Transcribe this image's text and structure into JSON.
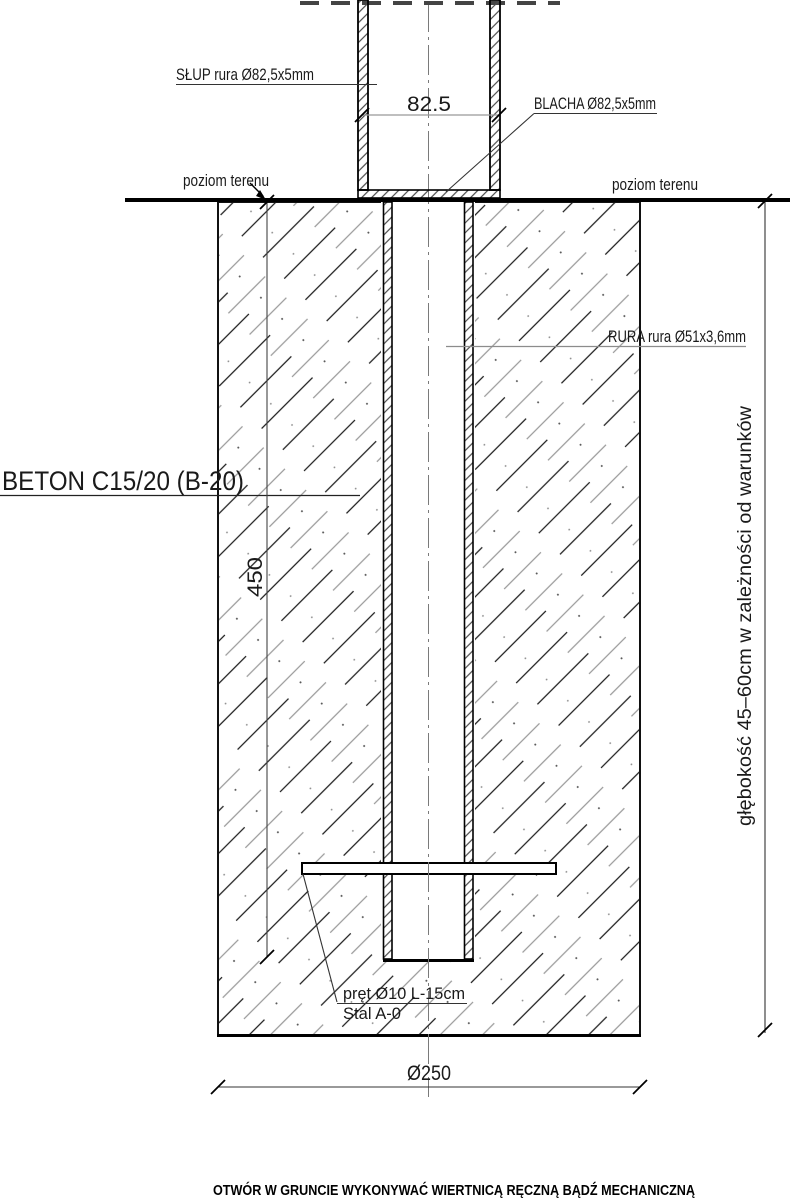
{
  "labels": {
    "slup": "SŁUP rura Ø82,5x5mm",
    "blacha": "BLACHA Ø82,5x5mm",
    "poziom_left": "poziom terenu",
    "poziom_right": "poziom terenu",
    "rura": "RURA rura Ø51x3,6mm",
    "beton": "BETON C15/20 (B-20)",
    "pret_line1": "pręt Ø10 L-15cm",
    "pret_line2": "Stal A-0",
    "glebokosc": "głębokość 45–60cm w zależności od warunków",
    "note": "OTWÓR W GRUNCIE WYKONYWAĆ WIERTNICĄ RĘCZNĄ BĄDŹ MECHANICZNĄ"
  },
  "dimensions": {
    "post_outer_width": "82.5",
    "embed_depth": "450",
    "hole_diameter": "Ø250"
  },
  "colors": {
    "line": "#000000",
    "secondary_line": "#8c8c8c",
    "background": "#ffffff"
  }
}
